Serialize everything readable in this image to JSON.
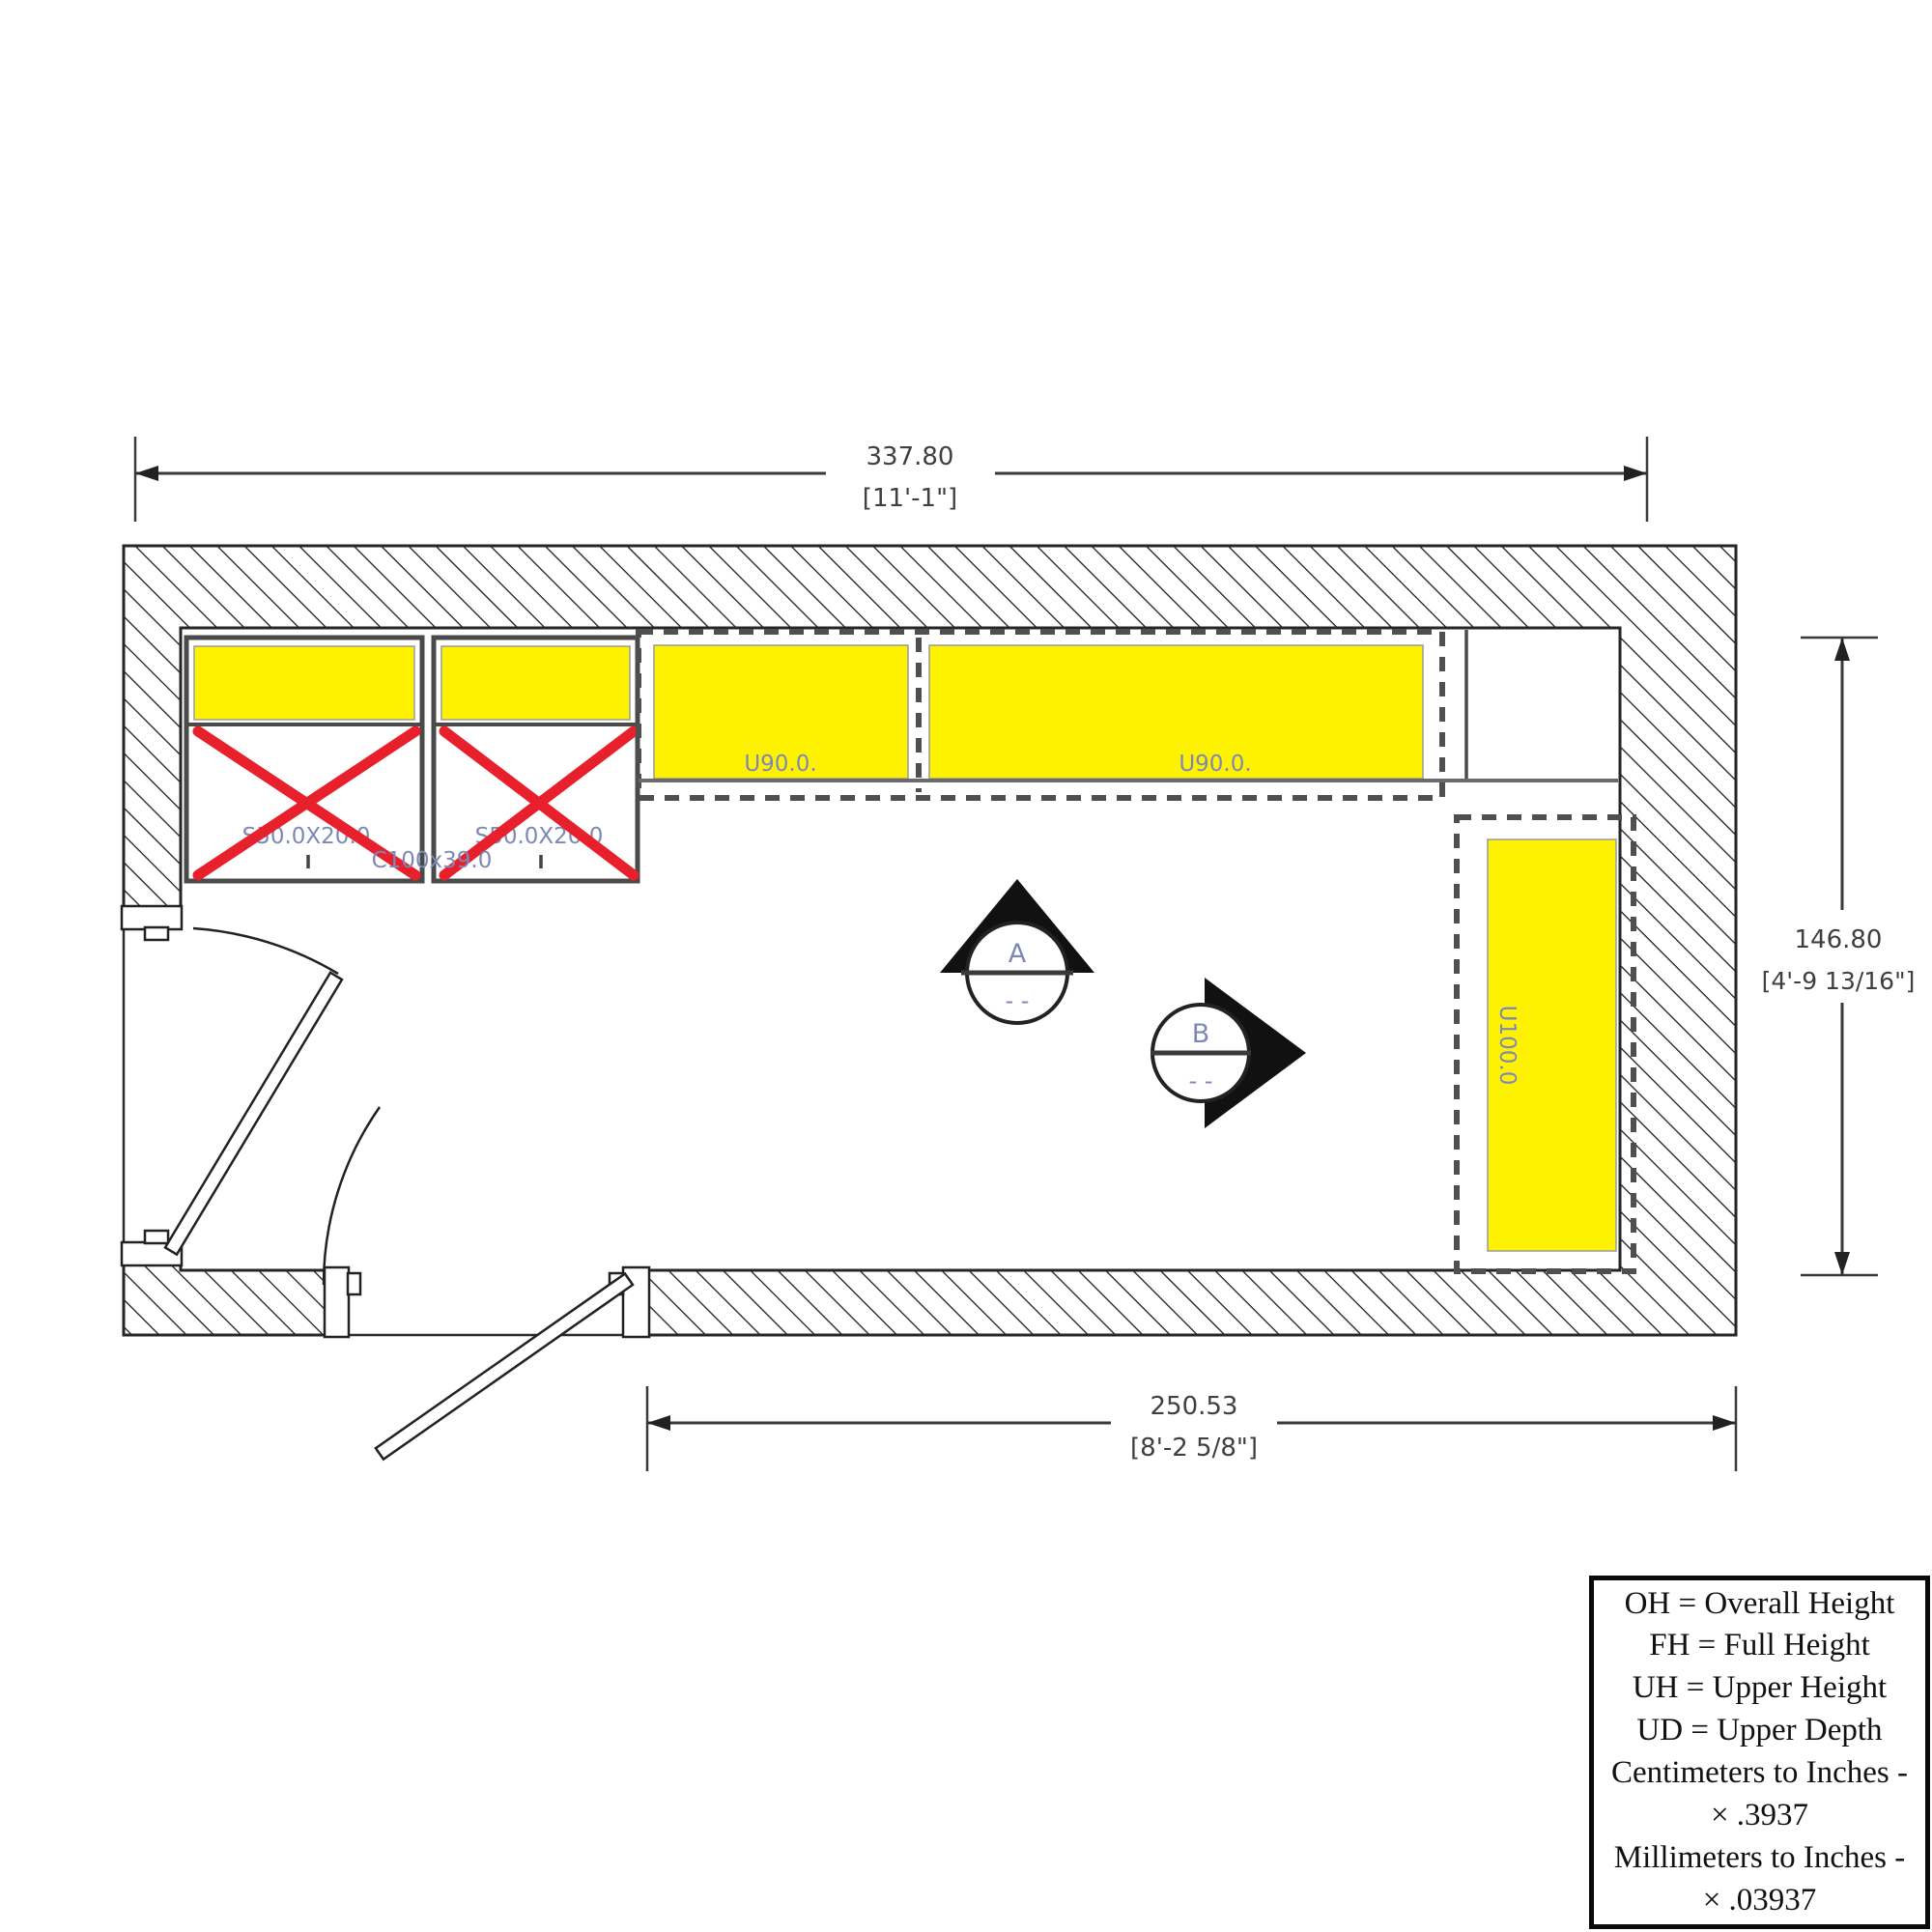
{
  "plan": {
    "dim_top": {
      "value": "337.80",
      "imperial": "[11'-1\"]"
    },
    "dim_right": {
      "value": "146.80",
      "imperial": "[4'-9 13/16\"]"
    },
    "dim_bottom": {
      "value": "250.53",
      "imperial": "[8'-2 5/8\"]"
    },
    "crossed_cabinets": {
      "box1_label": "S50.0X20.0",
      "box2_label": "S50.0X20.0",
      "center_label": "C100x39.0"
    },
    "upper_cabinets": {
      "left_label": "U90.0.",
      "right_label": "U90.0.",
      "tall_label": "U100.0"
    },
    "elevation_markers": {
      "a": {
        "id": "A",
        "sub": "- -"
      },
      "b": {
        "id": "B",
        "sub": "- -"
      }
    },
    "colors": {
      "highlight": "#FFF200",
      "cross_red": "#E8202C",
      "label_blue": "#7E88B6"
    }
  },
  "legend": {
    "lines": [
      "OH = Overall Height",
      "FH = Full Height",
      "UH = Upper Height",
      "UD = Upper Depth",
      "Centimeters to Inches -",
      "× .3937",
      "Millimeters to Inches -",
      "× .03937"
    ]
  }
}
